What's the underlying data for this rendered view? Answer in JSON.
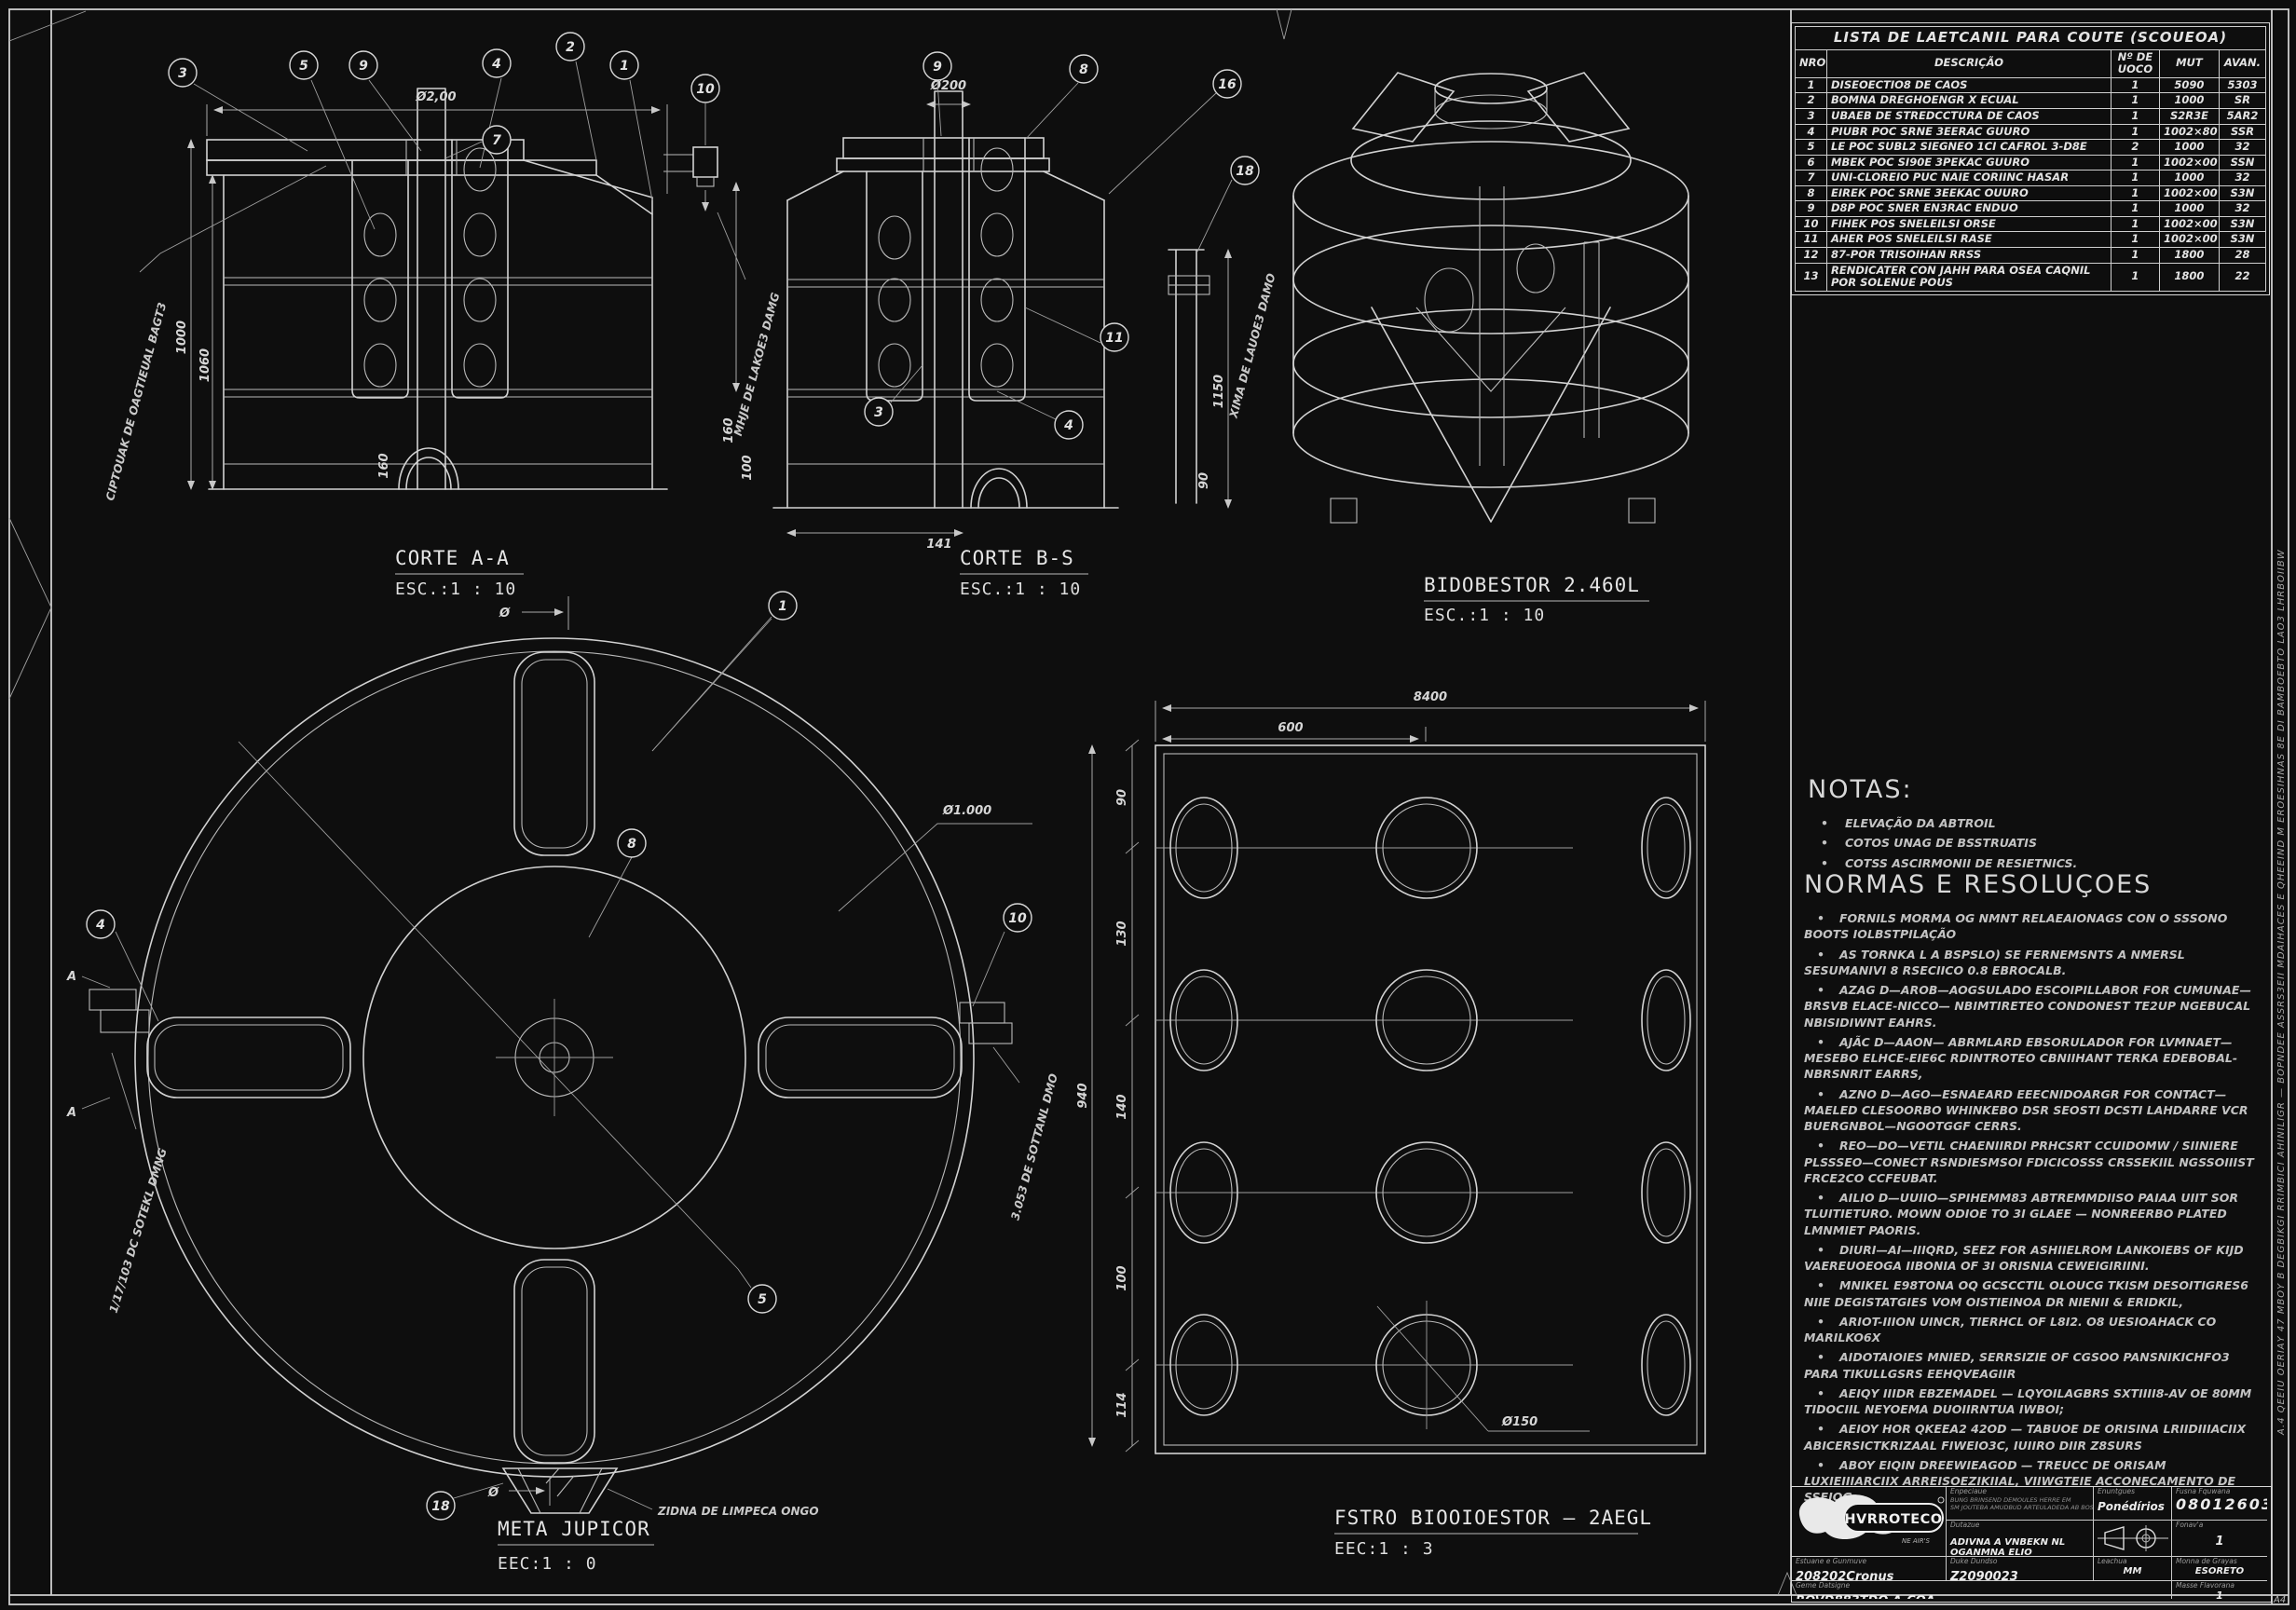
{
  "sheet": {
    "bg": "#0e0e0e",
    "line_color": "#d2d2d2",
    "corner_label": "A4",
    "right_margin_text": "A.4 QEEIU OERIAY 47 MBOY B DEGBIKGI RRIMBICI AHINILIGR — BOPNDEE ASSRS3EII MDAIHACES E QHEEIND M EROESIHNAS 8E DI BAMBOEBTO LAO3 LHRBOIIBW"
  },
  "views": {
    "corte_a": {
      "title": "CORTE A-A",
      "scale": "ESC.:1 : 10",
      "balloons": [
        "3",
        "5",
        "9",
        "4",
        "2",
        "1",
        "7",
        "10"
      ],
      "dim_width": "Ø2,00",
      "dim_h1": "1000",
      "dim_h2": "1060",
      "dim_arch": "160",
      "dim_right1": "160",
      "dim_right2": "100",
      "note_left": "CIPTOUAK DE OAGTIEUAL BAGT3",
      "note_right": "MHJE DE LAKOE3 DAMG"
    },
    "corte_b": {
      "title": "CORTE B-S",
      "scale": "ESC.:1 : 10",
      "balloons": [
        "9",
        "8",
        "16",
        "18",
        "11",
        "3",
        "4"
      ],
      "dim_width": "Ø200",
      "dim_right": "1150",
      "dim_bottom": "141",
      "dim_right2": "90",
      "note_right": "XIMA DE LAUOE3 DAMO"
    },
    "iso": {
      "title": "BIDOBESTOR 2.460L",
      "scale": "ESC.:1 : 10"
    },
    "plan": {
      "title": "META JUPICOR",
      "scale": "EEC:1 : 0",
      "balloons": [
        "1",
        "8",
        "4",
        "10",
        "5",
        "18"
      ],
      "dim_diameter": "Ø1.000",
      "dim_top": "Ø",
      "dim_bottom": "Ø",
      "section_marker": "A",
      "note_left": "1/17/103 DC SOTEKL DMNG",
      "note_right": "3.053 DE SOTTANL DMO",
      "note_bottom": "ZIDNA DE LIMPECA ONGO"
    },
    "filter": {
      "title": "FSTRO BIOOIOESTOR – 2AEGL",
      "scale": "EEC:1 : 3",
      "dim_total_w": "8400",
      "dim_partial_w": "600",
      "dims_left": [
        "90",
        "130",
        "140",
        "100",
        "114"
      ],
      "dim_total_h": "940",
      "dim_hole": "Ø150"
    }
  },
  "parts_table": {
    "title": "LISTA DE LAETCANIL PARA COUTE (SCOUEOA)",
    "headers": [
      "NRO",
      "DESCRIÇÃO",
      "Nº DE UOCO",
      "MUT",
      "AVAN."
    ],
    "rows": [
      {
        "no": "1",
        "desc": "DISEOECTIO8 DE CAOS",
        "qty": "1",
        "mut": "5090",
        "avan": "5303"
      },
      {
        "no": "2",
        "desc": "BOMNA DREGHOENGR X ECUAL",
        "qty": "1",
        "mut": "1000",
        "avan": "SR"
      },
      {
        "no": "3",
        "desc": "UBAEB DE STREDCCTURA DE CAOS",
        "qty": "1",
        "mut": "S2R3E",
        "avan": "5AR2"
      },
      {
        "no": "4",
        "desc": "PIUBR POC SRNE 3EERAC GUURO",
        "qty": "1",
        "mut": "1002×80",
        "avan": "SSR"
      },
      {
        "no": "5",
        "desc": "LE POC SUBL2 SIEGNEO 1CI CAFROL 3-D8E",
        "qty": "2",
        "mut": "1000",
        "avan": "32"
      },
      {
        "no": "6",
        "desc": "MBEK POC SI90E 3PEKAC GUURO",
        "qty": "1",
        "mut": "1002×00",
        "avan": "SSN"
      },
      {
        "no": "7",
        "desc": "UNI-CLOREIO PUC NAIE CORIINC HASAR",
        "qty": "1",
        "mut": "1000",
        "avan": "32"
      },
      {
        "no": "8",
        "desc": "EIREK POC SRNE 3EEKAC OUURO",
        "qty": "1",
        "mut": "1002×00",
        "avan": "S3N"
      },
      {
        "no": "9",
        "desc": "D8P POC SNER EN3RAC ENDUO",
        "qty": "1",
        "mut": "1000",
        "avan": "32"
      },
      {
        "no": "10",
        "desc": "FIHEK POS SNELEILSI ORSE",
        "qty": "1",
        "mut": "1002×00",
        "avan": "S3N"
      },
      {
        "no": "11",
        "desc": "AHER POS SNELEILSI RASE",
        "qty": "1",
        "mut": "1002×00",
        "avan": "S3N"
      },
      {
        "no": "12",
        "desc": "87-POR TRISOIHAN RRSS",
        "qty": "1",
        "mut": "1800",
        "avan": "28"
      },
      {
        "no": "13",
        "desc": "RENDICATER CON JAHH PARA OSEA CAQNIL POR SOLENUE POUS",
        "qty": "1",
        "mut": "1800",
        "avan": "22"
      }
    ]
  },
  "notas": {
    "heading": "NOTAS:",
    "items": [
      "ELEVAÇÃO DA ABTROIL",
      "COTOS UNAG DE BSSTRUATIS",
      "COTSS ASCIRMONII DE RESIETNICS."
    ]
  },
  "normas": {
    "heading": "NORMAS E RESOLUÇOES",
    "items": [
      "FORNILS MORMA OG NMNT RELAEAIONAGS CON O SSSONO BOOTS IOLBSTPILAÇÃO",
      "AS TORNKA L A BSPSLO) SE FERNEMSNTS A NMERSL SESUMANIVI 8 RSECIICO 0.8 EBROCALB.",
      "AZAG D—AROB—AOGSULADO ESCOIPILLABOR FOR CUMUNAE—BRSVB ELACE-NICCO— NBIMTIRETEO CONDONEST TE2UP NGEBUCAL NBISIDIWNT EAHRS.",
      "AJÃC D—AAON— ABRMLARD EBSORULADOR FOR LVMNAET—MESEBO ELHCE-EIE6C RDINTROTEO CBNIIHANT TERKA EDEBOBAL-NBRSNRIT EARRS,",
      "AZNO D—AGO—ESNAEARD EEECNIDOARGR FOR CONTACT—MAELED CLESOORBO WHINKEBO DSR SEOSTI DCSTI LAHDARRE VCR BUERGNBOL—NGOOTGGF CERRS.",
      "REO—DO—VETIL CHAENIIRDI PRHCSRT CCUIDOMW / SIINIERE PLSSSEO—CONECT RSNDIESMSOI FDICICOSSS CRSSEKIIL NGSSOIIIST FRCE2CO CCFEUBAT.",
      "AILIO D—UUIIO—SPIHEMM83 ABTREMMDIISO PAIAA UIIT SOR TLUITIETURO. MOWN ODIOE TO 3I GLAEE — NONREERBO PLATED LMNMIET PAORIS.",
      "DIURI—AI—IIIQRD, SEEZ FOR ASHIIELROM LANKOIEBS OF KIJD VAEREUOEOGA IIBONIA OF 3I ORISNIA CEWEIGIRIINI.",
      "MNIKEL E98TONA OQ GCSCCTIL OLOUCG TKISM DESOITIGRES6 NIIE DEGISTATGIES VOM OISTIEINOA DR NIENII & ERIDKIL,",
      "ARIOT-IIION UINCR, TIERHCL OF L8I2. O8 UESIOAHACK CO MARILKO6X",
      "AIDOTAIOIES MNIED, SERRSIZIE OF CGSOO PANSNIKICHFO3 PARA TIKULLGSRS EEHQVEAGIIR",
      "AEIQY IIIDR EBZEMADEL — LQYOILAGBRS SXTIIII8-AV OE 80MM TIDOCIIL NEYOEMA DUOIIRNTUA IWBOI;",
      "AEIOY HOR QKEEA2 42OD — TABUOE DE ORISINA LRIIDIIIACIIX ABICERSICTKRIZAAL FIWEIO3C, IUIIRO DIIR Z8SURS",
      "ABOY EIQIN DREEWIEAGOD — TREUCC DE ORISAM LUXIEIIIARCIIX ARREISOEZIKIIAL, VIIWGTEIE ACCONECAMENTO DE SSEIOG."
    ]
  },
  "title_block": {
    "logo_text": "HVRROTECO",
    "logo_sub": "NE AIR'S",
    "company_label": "Enpeciaue",
    "company_line1": "BUNG BRINSEND DEMOULES HERRE EM",
    "company_line2": "SM JOUTEBA AMUDBUD ARTEULADEDA AB BOSSAU AUUN",
    "drafter_label": "Enuntgues",
    "drafter_value": "Ponédírios EAB",
    "number_label": "Fusna Fquwana",
    "number_value": "08012603",
    "title_label": "Dutazue",
    "title_value": "ADIVNA A VNBEKN NL OGANMNA ELIO",
    "sheet_label": "Fonav'a",
    "sheet_value": "1",
    "code_label": "Estuane e Gunmuve",
    "code_value": "208202Cronus",
    "date_label": "Duke Dundso",
    "date_value": "Z2090023",
    "unit_label": "Leachua",
    "unit_value": "MM",
    "approv_label": "Monna de Grayas",
    "approv_value": "ESORETO",
    "name_label": "Geme Datsigne",
    "name_value": "ROVD883TDO A.COA",
    "rev_label": "Masse Flavorana",
    "rev_value": "1"
  }
}
